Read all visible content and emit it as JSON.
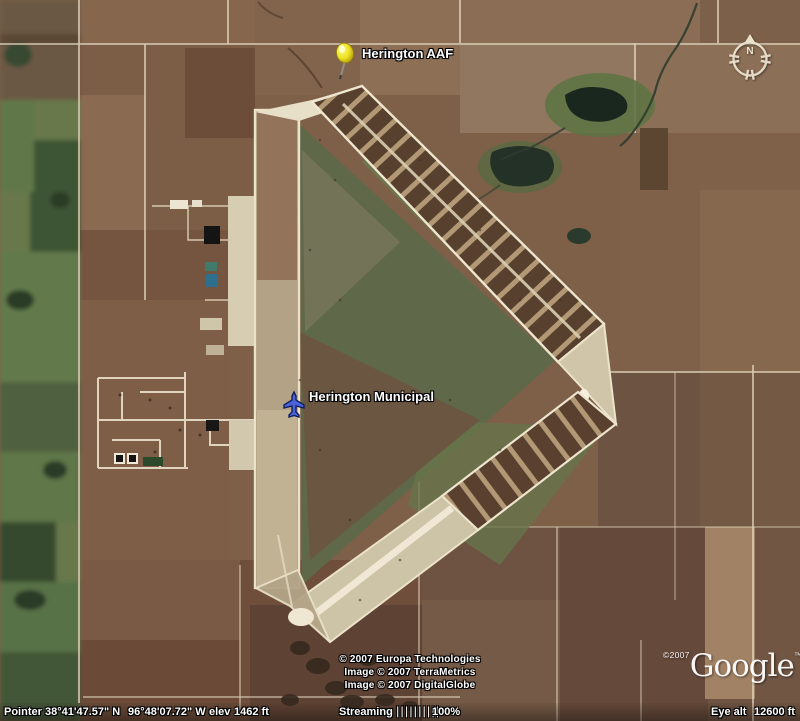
{
  "app": {
    "name": "Google Earth satellite view"
  },
  "placemarks": [
    {
      "id": "herington-aaf",
      "label": "Herington AAF",
      "type": "pushpin"
    },
    {
      "id": "herington-municipal",
      "label": "Herington Municipal",
      "type": "airport"
    }
  ],
  "compass": {
    "north_label": "N"
  },
  "attribution": {
    "line1": "© 2007 Europa Technologies",
    "line2": "Image © 2007 TerraMetrics",
    "line3": "Image © 2007 DigitalGlobe"
  },
  "logo": {
    "copyright": "©2007",
    "brand": "Google",
    "tm": "™"
  },
  "status_bar": {
    "pointer_label": "Pointer",
    "latitude": "38°41'47.57\" N",
    "longitude": "96°48'07.72\" W",
    "elev_label": "elev",
    "elevation": "1462 ft",
    "streaming_label": "Streaming",
    "streaming_bars": "||||||||||",
    "streaming_percent": "100%",
    "eye_alt_label": "Eye alt",
    "eye_altitude": "12600 ft"
  },
  "colors": {
    "pushpin_yellow": "#f0e42a",
    "airplane_blue": "#3d5bc8",
    "label_white": "#ffffff",
    "runway_cream": "#efe6cf"
  }
}
